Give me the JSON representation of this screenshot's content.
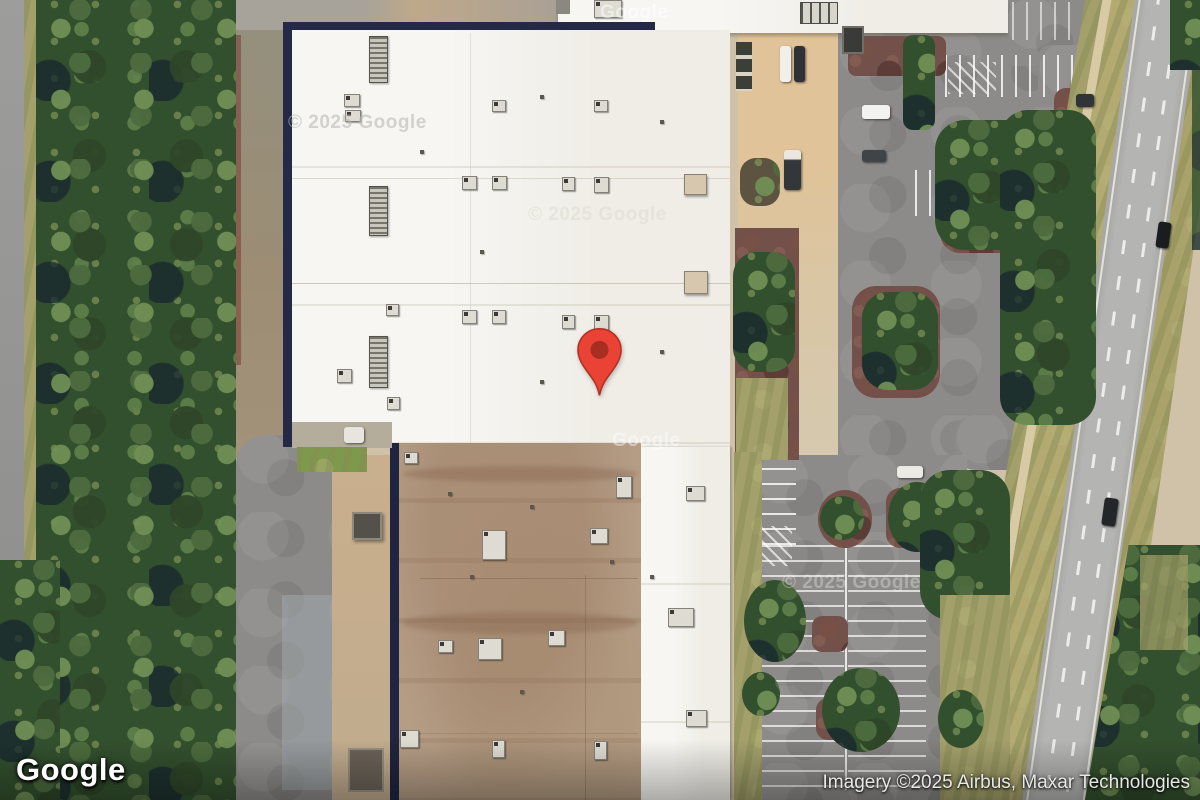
{
  "map": {
    "view": "satellite",
    "logo": "Google",
    "attribution": "Imagery ©2025 Airbus, Maxar Technologies",
    "marker": {
      "name": "location-pin",
      "color": "#EA4335",
      "dot_color": "#A72E21"
    },
    "watermarks": [
      {
        "text": "© 2025 Google"
      },
      {
        "text": "© 2025 Google"
      },
      {
        "text": "Google"
      },
      {
        "text": "Google"
      },
      {
        "text": "© 2025 Google"
      }
    ],
    "colors": {
      "marker_red": "#EA4335",
      "roof_white": "#EFEDE6",
      "roof_tan": "#B59C85",
      "building_edge_navy": "#242A46",
      "asphalt": "#8D8B89",
      "foliage_dark": "#33502E",
      "concrete_sand": "#DDC09A"
    }
  }
}
